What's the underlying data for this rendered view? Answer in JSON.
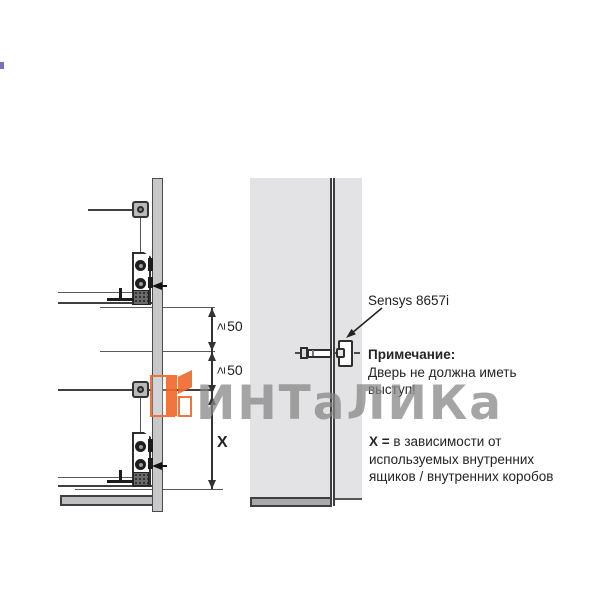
{
  "colors": {
    "accent": "#f06a2f",
    "watermark-gray": "#868686",
    "panel": "#c8c8ca",
    "door": "#e3e3e6",
    "band": "#a9a9ab",
    "text": "#2a2a2a"
  },
  "watermark": {
    "text": "ИНТаЛИКа"
  },
  "diagram": {
    "dims": {
      "dim1": {
        "symbol": "≥",
        "value": "50"
      },
      "dim2": {
        "symbol": "≥",
        "value": "50"
      },
      "x_label": "X"
    },
    "hinge_label": "Sensys 8657i",
    "note": {
      "title": "Примечание:",
      "line1": "Дверь не должна иметь",
      "line2": "выступ!"
    },
    "x_note": {
      "bold": "X =",
      "line1": "в зависимости от",
      "line2": "используемых внутренних",
      "line3": "ящиков / внутренних коробов"
    }
  }
}
